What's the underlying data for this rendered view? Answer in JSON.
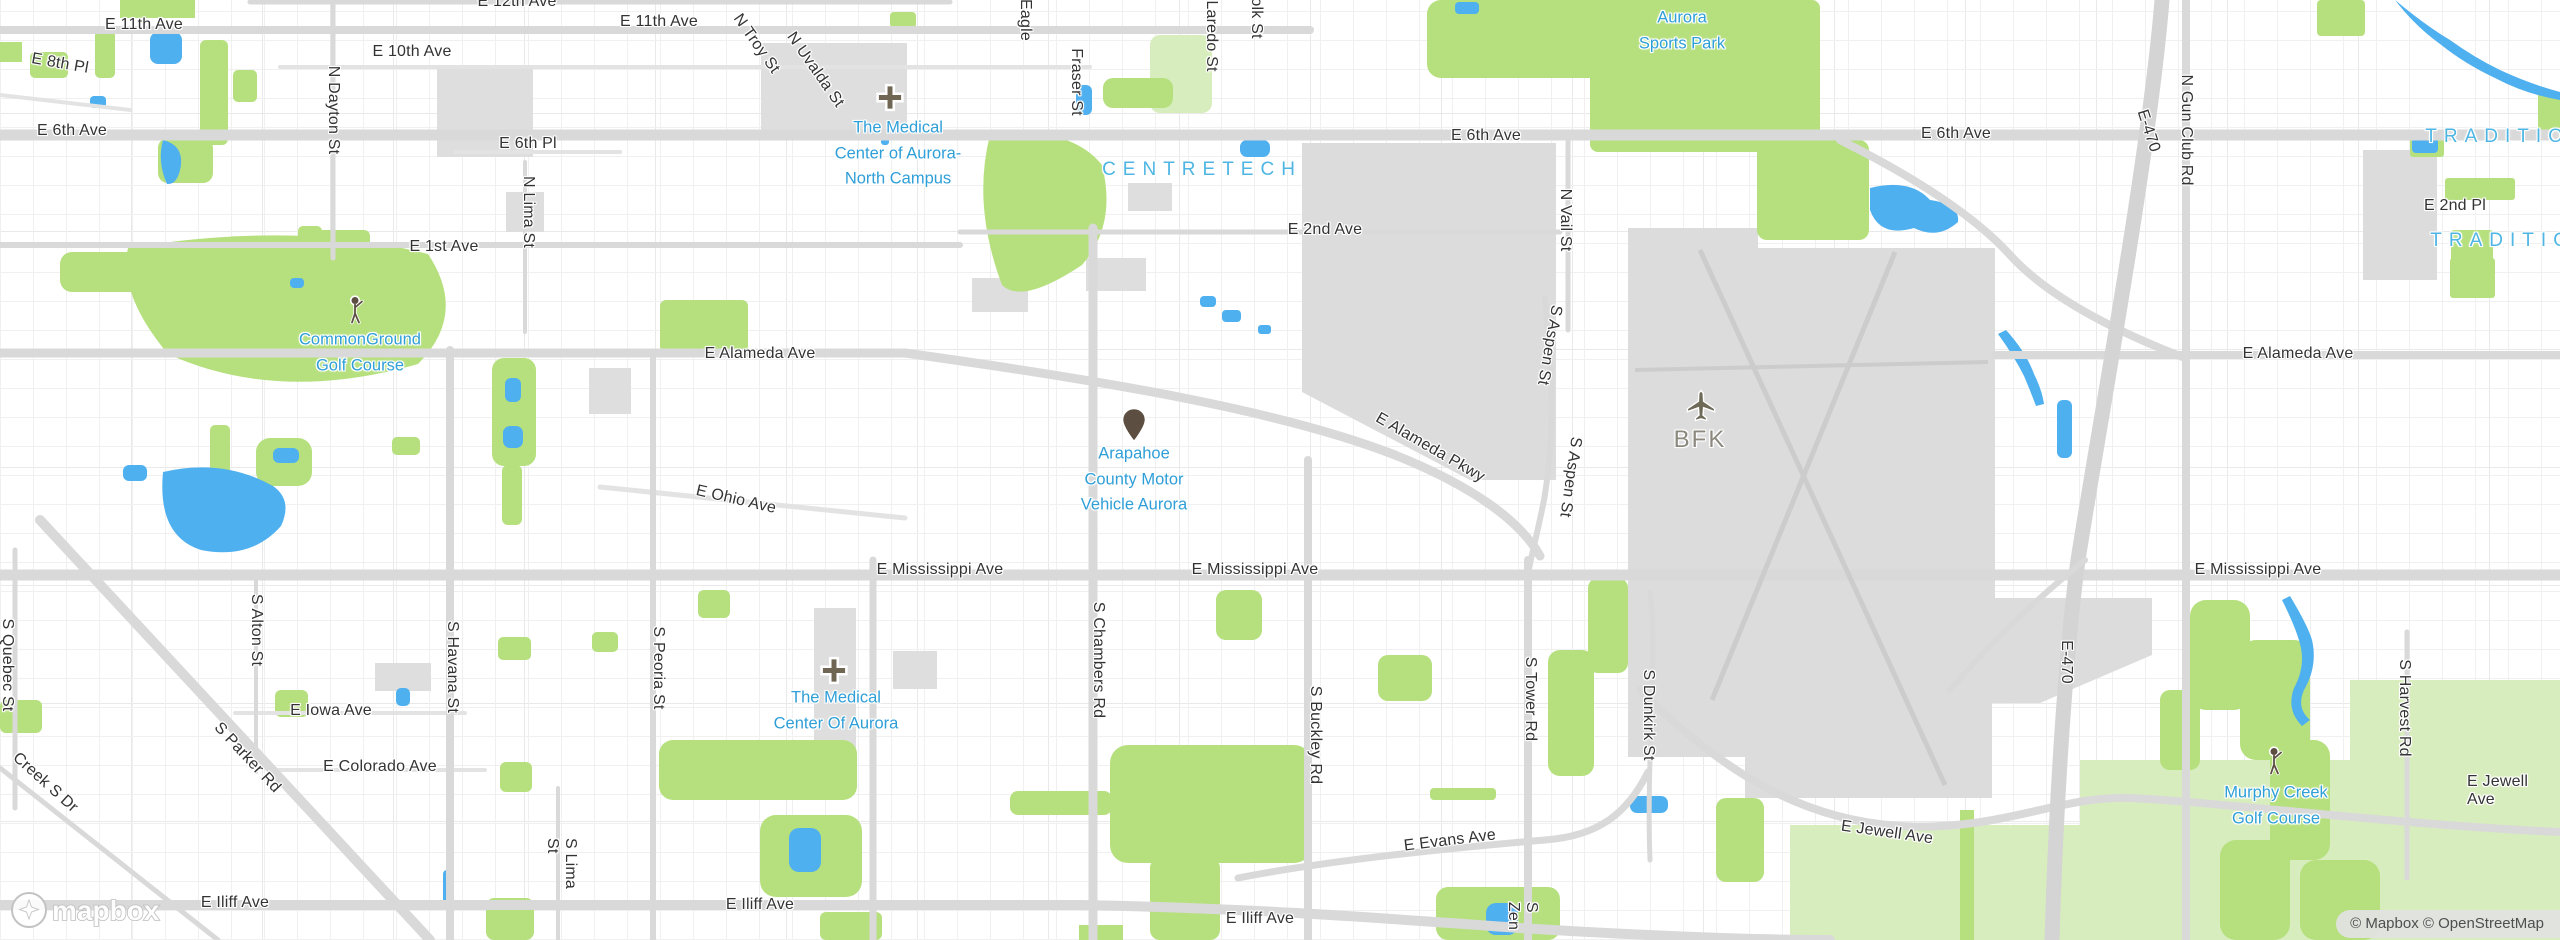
{
  "map": {
    "attribution": "© Mapbox © OpenStreetMap",
    "logo_text": "mapbox",
    "colors": {
      "park_green": "#b6e07e",
      "park_pale": "#d8edbd",
      "water_blue": "#4fb0f0",
      "road_gray": "#d9d9d9",
      "airport_gray": "#dcdcdc",
      "runway_gray": "#cccccc",
      "poi_blue": "#2f9fd8",
      "area_blue": "#4fb6e4",
      "road_label": "#333333",
      "airport_code": "#8b897e",
      "icon_brown": "#5f5443"
    },
    "labels": [
      {
        "t": "E 11th Ave",
        "k": "road",
        "x": 144,
        "y": 25
      },
      {
        "t": "E 12th Ave",
        "k": "road",
        "x": 517,
        "y": 2
      },
      {
        "t": "E 11th Ave",
        "k": "road",
        "x": 659,
        "y": 22
      },
      {
        "t": "E 10th Ave",
        "k": "road",
        "x": 412,
        "y": 52
      },
      {
        "t": "E 8th Pl",
        "k": "road",
        "x": 60,
        "y": 64,
        "r": 10
      },
      {
        "t": "E 6th Ave",
        "k": "road",
        "x": 72,
        "y": 131
      },
      {
        "t": "E 6th Pl",
        "k": "road",
        "x": 528,
        "y": 144
      },
      {
        "t": "N Dayton St",
        "k": "road",
        "x": 333,
        "y": 110,
        "v": true
      },
      {
        "t": "N Lima St",
        "k": "road",
        "x": 528,
        "y": 212,
        "v": true
      },
      {
        "t": "N Troy St",
        "k": "road",
        "x": 756,
        "y": 44,
        "r": 55
      },
      {
        "t": "N Uvalda St",
        "k": "road",
        "x": 815,
        "y": 70,
        "r": 55
      },
      {
        "t": "Eagle",
        "k": "road",
        "x": 1025,
        "y": 20,
        "v": true
      },
      {
        "t": "Fraser St",
        "k": "road",
        "x": 1076,
        "y": 82,
        "v": true
      },
      {
        "t": "Laredo St",
        "k": "road",
        "x": 1211,
        "y": 36,
        "v": true
      },
      {
        "t": "olk St",
        "k": "road",
        "x": 1256,
        "y": 18,
        "v": true
      },
      {
        "t": "E 6th Ave",
        "k": "road",
        "x": 1486,
        "y": 136
      },
      {
        "t": "E 6th Ave",
        "k": "road",
        "x": 1956,
        "y": 134
      },
      {
        "t": "E 2nd Ave",
        "k": "road",
        "x": 1325,
        "y": 230
      },
      {
        "t": "E 2nd Pl",
        "k": "road",
        "x": 2455,
        "y": 206
      },
      {
        "t": "E 1st Ave",
        "k": "road",
        "x": 444,
        "y": 247
      },
      {
        "t": "N Vail St",
        "k": "road",
        "x": 1565,
        "y": 220,
        "v": true
      },
      {
        "t": "N Gun Club Rd",
        "k": "road",
        "x": 2186,
        "y": 130,
        "v": true
      },
      {
        "t": "E-470",
        "k": "road",
        "x": 2148,
        "y": 131,
        "r": 72
      },
      {
        "t": "E Alameda Ave",
        "k": "road",
        "x": 760,
        "y": 354
      },
      {
        "t": "E Alameda Ave",
        "k": "road",
        "x": 2298,
        "y": 354
      },
      {
        "t": "E Alameda Pkwy",
        "k": "road",
        "x": 1430,
        "y": 448,
        "r": 30
      },
      {
        "t": "S Aspen St",
        "k": "road",
        "x": 1549,
        "y": 345,
        "v": true,
        "r": 10
      },
      {
        "t": "S Aspen St",
        "k": "road",
        "x": 1570,
        "y": 477,
        "v": true,
        "r": 8
      },
      {
        "t": "E Ohio Ave",
        "k": "road",
        "x": 736,
        "y": 500,
        "r": 13
      },
      {
        "t": "E Mississippi Ave",
        "k": "road",
        "x": 940,
        "y": 570
      },
      {
        "t": "E Mississippi Ave",
        "k": "road",
        "x": 1255,
        "y": 570
      },
      {
        "t": "E Mississippi Ave",
        "k": "road",
        "x": 2258,
        "y": 570
      },
      {
        "t": "S Chambers Rd",
        "k": "road",
        "x": 1098,
        "y": 660,
        "v": true
      },
      {
        "t": "S Buckley Rd",
        "k": "road",
        "x": 1315,
        "y": 735,
        "v": true
      },
      {
        "t": "S Tower Rd",
        "k": "road",
        "x": 1530,
        "y": 699,
        "v": true
      },
      {
        "t": "S Dunkirk St",
        "k": "road",
        "x": 1648,
        "y": 715,
        "v": true
      },
      {
        "t": "S Havana St",
        "k": "road",
        "x": 452,
        "y": 667,
        "v": true
      },
      {
        "t": "S Peoria St",
        "k": "road",
        "x": 658,
        "y": 668,
        "v": true
      },
      {
        "t": "S Alton St",
        "k": "road",
        "x": 256,
        "y": 630,
        "v": true
      },
      {
        "t": "S Quebec St",
        "k": "road",
        "x": 7,
        "y": 665,
        "v": true
      },
      {
        "t": "Creek S Dr",
        "k": "road",
        "x": 45,
        "y": 783,
        "r": 42
      },
      {
        "t": "S Parker Rd",
        "k": "road",
        "x": 247,
        "y": 758,
        "r": 47
      },
      {
        "t": "E Iowa Ave",
        "k": "road",
        "x": 331,
        "y": 711
      },
      {
        "t": "E Colorado Ave",
        "k": "road",
        "x": 380,
        "y": 767
      },
      {
        "t": "S Lima St",
        "k": "road",
        "x": 561,
        "y": 872,
        "v": true
      },
      {
        "t": "E Iliff Ave",
        "k": "road",
        "x": 235,
        "y": 903
      },
      {
        "t": "E Iliff Ave",
        "k": "road",
        "x": 760,
        "y": 905
      },
      {
        "t": "E Iliff Ave",
        "k": "road",
        "x": 1260,
        "y": 919
      },
      {
        "t": "E Evans Ave",
        "k": "road",
        "x": 1450,
        "y": 841,
        "r": -7
      },
      {
        "t": "E Jewell Ave",
        "k": "road",
        "x": 1887,
        "y": 833,
        "r": 8
      },
      {
        "t": "E Jewell Ave",
        "k": "road",
        "x": 2498,
        "y": 791
      },
      {
        "t": "S Harvest Rd",
        "k": "road",
        "x": 2404,
        "y": 708,
        "v": true
      },
      {
        "t": "E-470",
        "k": "road",
        "x": 2066,
        "y": 662,
        "v": true
      },
      {
        "t": "S Zen",
        "k": "road",
        "x": 1522,
        "y": 916,
        "v": true
      },
      {
        "t": "The Medical\nCenter of Aurora-\nNorth Campus",
        "k": "poi",
        "x": 898,
        "y": 154
      },
      {
        "t": "The Medical\nCenter Of Aurora",
        "k": "poi",
        "x": 836,
        "y": 711
      },
      {
        "t": "Arapahoe\nCounty Motor\nVehicle Aurora",
        "k": "poi",
        "x": 1134,
        "y": 480
      },
      {
        "t": "CommonGround\nGolf Course",
        "k": "poi",
        "x": 360,
        "y": 353
      },
      {
        "t": "Murphy Creek\nGolf Course",
        "k": "poi",
        "x": 2276,
        "y": 806
      },
      {
        "t": "Aurora\nSports Park",
        "k": "poi",
        "x": 1682,
        "y": 31
      },
      {
        "t": "CENTRETECH",
        "k": "area",
        "x": 1202,
        "y": 170
      },
      {
        "t": "TRADITION",
        "k": "area",
        "x": 2508,
        "y": 137
      },
      {
        "t": "TRADITION",
        "k": "area",
        "x": 2513,
        "y": 241
      },
      {
        "t": "BFK",
        "k": "code",
        "x": 1700,
        "y": 440
      }
    ],
    "icons": [
      {
        "type": "hospital",
        "x": 890,
        "y": 100
      },
      {
        "type": "hospital",
        "x": 834,
        "y": 673
      },
      {
        "type": "pin",
        "x": 1134,
        "y": 428
      },
      {
        "type": "golfer",
        "x": 356,
        "y": 313
      },
      {
        "type": "golfer",
        "x": 2275,
        "y": 764
      },
      {
        "type": "airplane",
        "x": 1701,
        "y": 408
      }
    ]
  }
}
